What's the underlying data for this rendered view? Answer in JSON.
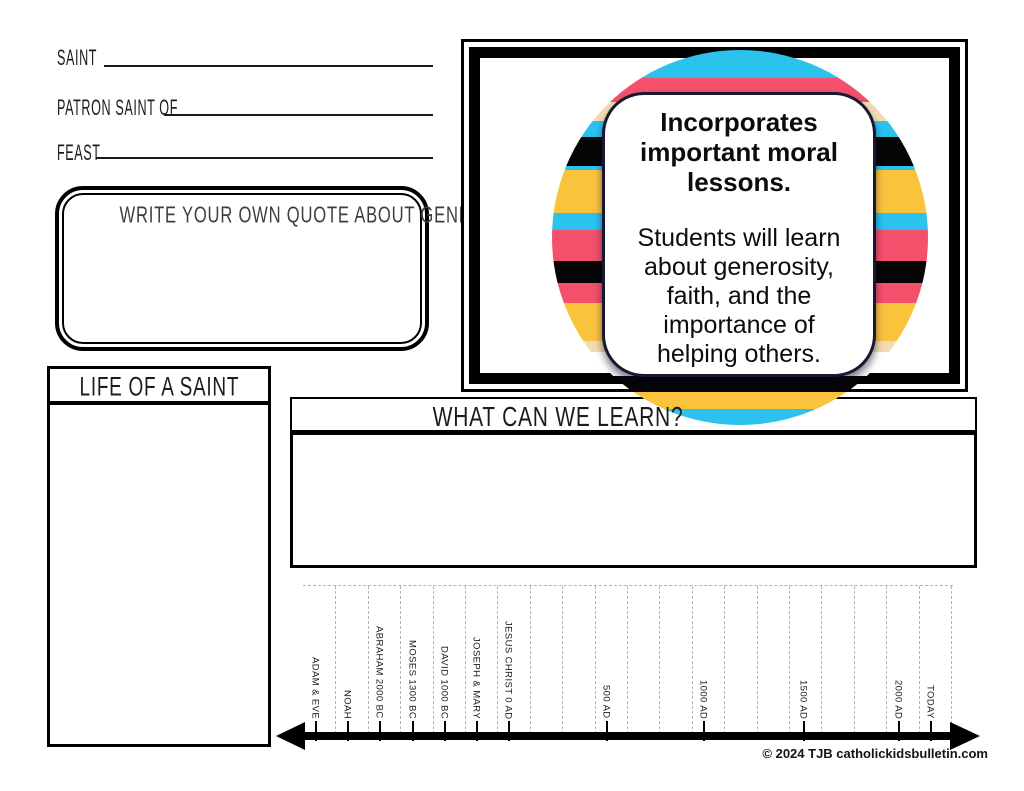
{
  "fields": [
    {
      "label": "SAINT"
    },
    {
      "label": "PATRON SAINT OF"
    },
    {
      "label": "FEAST"
    }
  ],
  "quote_box": {
    "title": "WRITE YOUR OWN QUOTE ABOUT GENEROSITY"
  },
  "life_box": {
    "title": "LIFE OF A SAINT"
  },
  "learn_box": {
    "title": "WHAT CAN WE LEARN?"
  },
  "info_card": {
    "heading_lines": [
      "Incorporates",
      "important moral",
      "lessons."
    ],
    "body_lines": [
      "Students will learn",
      "about generosity,",
      "faith, and the",
      "importance of",
      "helping others."
    ]
  },
  "colors": {
    "cyan": "#2BC2EE",
    "pink": "#F4506C",
    "cream": "#F2DCB3",
    "yellow": "#FAC33C",
    "black": "#050505",
    "card_border": "#181832"
  },
  "circle_stripes": [
    {
      "color": "#2BC2EE",
      "from": 0,
      "to": 28
    },
    {
      "color": "#F4506C",
      "from": 28,
      "to": 52
    },
    {
      "color": "#F2DCB3",
      "from": 52,
      "to": 71
    },
    {
      "color": "#2BC2EE",
      "from": 71,
      "to": 87
    },
    {
      "color": "#050505",
      "from": 87,
      "to": 116
    },
    {
      "color": "#2BC2EE",
      "from": 116,
      "to": 120
    },
    {
      "color": "#FAC33C",
      "from": 120,
      "to": 163
    },
    {
      "color": "#2BC2EE",
      "from": 163,
      "to": 180
    },
    {
      "color": "#F4506C",
      "from": 180,
      "to": 211
    },
    {
      "color": "#050505",
      "from": 211,
      "to": 233
    },
    {
      "color": "#F4506C",
      "from": 233,
      "to": 253
    },
    {
      "color": "#FAC33C",
      "from": 253,
      "to": 291
    },
    {
      "color": "#F2DCB3",
      "from": 291,
      "to": 302
    },
    {
      "color": "#ffffff",
      "from": 302,
      "to": 326
    },
    {
      "color": "#050505",
      "from": 326,
      "to": 342
    },
    {
      "color": "#FAC33C",
      "from": 342,
      "to": 359
    },
    {
      "color": "#2BC2EE",
      "from": 359,
      "to": 375
    }
  ],
  "timeline": {
    "labels": [
      {
        "text": "ADAM & EVE",
        "x": 316
      },
      {
        "text": "NOAH",
        "x": 348
      },
      {
        "text": "ABRAHAM 2000 BC",
        "x": 380
      },
      {
        "text": "MOSES 1300 BC",
        "x": 413
      },
      {
        "text": "DAVID 1000 BC",
        "x": 445
      },
      {
        "text": "JOSEPH & MARY",
        "x": 477
      },
      {
        "text": "JESUS CHRIST 0 AD",
        "x": 509
      },
      {
        "text": "500 AD",
        "x": 607
      },
      {
        "text": "1000 AD",
        "x": 704
      },
      {
        "text": "1500 AD",
        "x": 804
      },
      {
        "text": "2000 AD",
        "x": 899
      },
      {
        "text": "TODAY",
        "x": 931
      }
    ],
    "gridline_count": 21,
    "gridline_spacing": 32.4
  },
  "copyright": "© 2024 TJB catholickidsbulletin.com"
}
